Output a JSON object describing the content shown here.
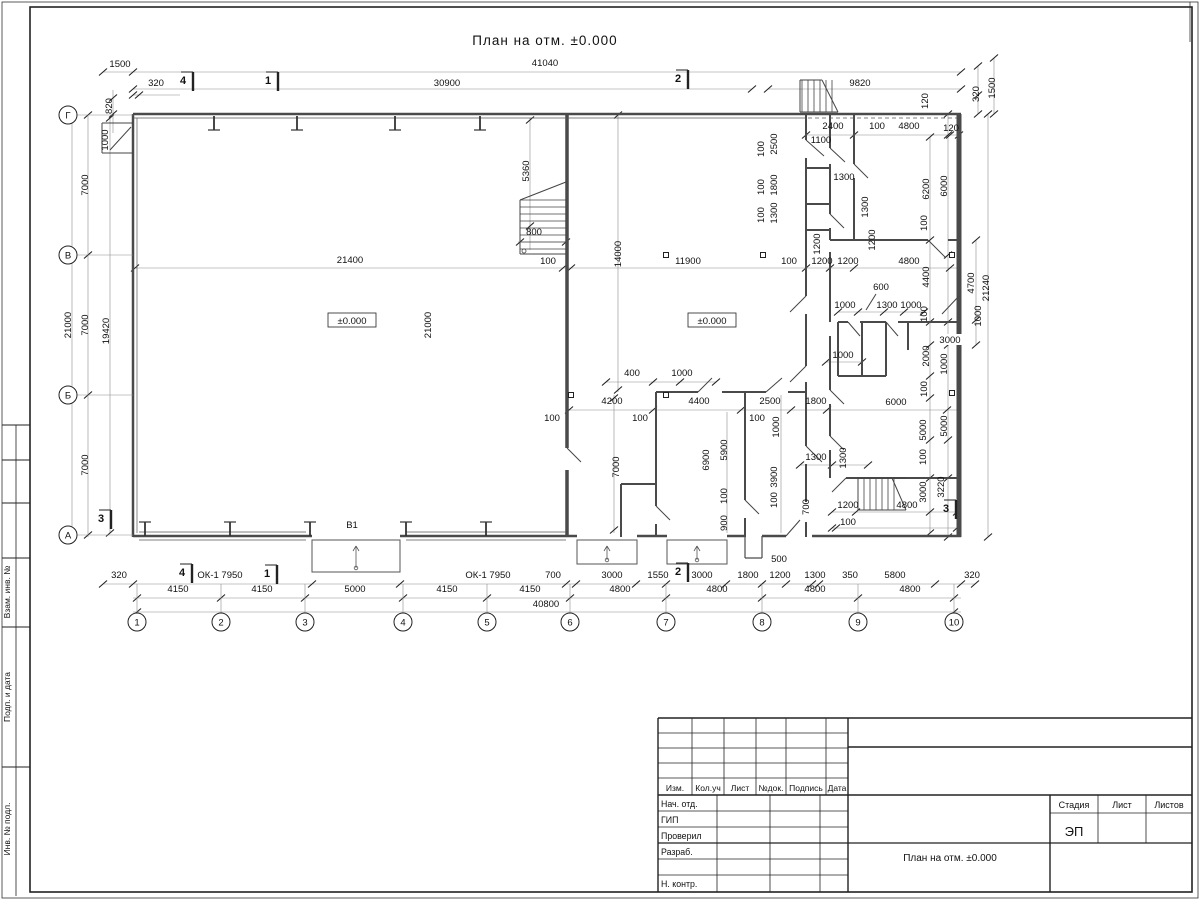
{
  "plan": {
    "title": "План на отм. ±0.000",
    "axis_cols": [
      {
        "label": "1",
        "x": 137
      },
      {
        "label": "2",
        "x": 221
      },
      {
        "label": "3",
        "x": 305
      },
      {
        "label": "4",
        "x": 403
      },
      {
        "label": "5",
        "x": 487
      },
      {
        "label": "6",
        "x": 570
      },
      {
        "label": "7",
        "x": 666
      },
      {
        "label": "8",
        "x": 762
      },
      {
        "label": "9",
        "x": 858
      },
      {
        "label": "10",
        "x": 954
      }
    ],
    "axis_rows": [
      {
        "label": "Г",
        "y": 115
      },
      {
        "label": "В",
        "y": 255
      },
      {
        "label": "Б",
        "y": 395
      },
      {
        "label": "А",
        "y": 535
      }
    ],
    "section_marks": [
      {
        "t": "4",
        "x": 183,
        "y": 81
      },
      {
        "t": "1",
        "x": 268,
        "y": 81
      },
      {
        "t": "2",
        "x": 678,
        "y": 79
      },
      {
        "t": "4",
        "x": 182,
        "y": 573
      },
      {
        "t": "1",
        "x": 267,
        "y": 574
      },
      {
        "t": "2",
        "x": 678,
        "y": 572
      },
      {
        "t": "3",
        "x": 101,
        "y": 519
      },
      {
        "t": "3",
        "x": 946,
        "y": 509
      }
    ],
    "levels": [
      {
        "t": "±0.000",
        "x": 352,
        "y": 323
      },
      {
        "t": "±0.000",
        "x": 712,
        "y": 323
      }
    ],
    "windows": [
      {
        "t": "ОК-1 7950",
        "x": 220,
        "y": 578
      },
      {
        "t": "ОК-1 7950",
        "x": 488,
        "y": 578
      }
    ],
    "gate": {
      "t": "В1",
      "x": 352,
      "y": 528
    },
    "dim_labels": [
      {
        "t": "41040",
        "x": 545,
        "y": 66
      },
      {
        "t": "30900",
        "x": 447,
        "y": 86
      },
      {
        "t": "9820",
        "x": 860,
        "y": 86
      },
      {
        "t": "1500",
        "x": 120,
        "y": 67
      },
      {
        "t": "320",
        "x": 156,
        "y": 86
      },
      {
        "t": "820",
        "x": 112,
        "y": 106,
        "r": 1
      },
      {
        "t": "1000",
        "x": 108,
        "y": 140,
        "r": 1
      },
      {
        "t": "120",
        "x": 928,
        "y": 101,
        "r": 1
      },
      {
        "t": "320",
        "x": 979,
        "y": 94,
        "r": 1
      },
      {
        "t": "1500",
        "x": 995,
        "y": 88,
        "r": 1
      },
      {
        "t": "2400",
        "x": 833,
        "y": 129
      },
      {
        "t": "100",
        "x": 877,
        "y": 129
      },
      {
        "t": "4800",
        "x": 909,
        "y": 129
      },
      {
        "t": "120",
        "x": 951,
        "y": 131
      },
      {
        "t": "1100",
        "x": 821,
        "y": 143
      },
      {
        "t": "1300",
        "x": 844,
        "y": 180
      },
      {
        "t": "100",
        "x": 764,
        "y": 149,
        "r": 1
      },
      {
        "t": "2500",
        "x": 777,
        "y": 144,
        "r": 1
      },
      {
        "t": "100",
        "x": 764,
        "y": 187,
        "r": 1
      },
      {
        "t": "1800",
        "x": 777,
        "y": 185,
        "r": 1
      },
      {
        "t": "100",
        "x": 764,
        "y": 215,
        "r": 1
      },
      {
        "t": "1300",
        "x": 777,
        "y": 213,
        "r": 1
      },
      {
        "t": "1200",
        "x": 820,
        "y": 244,
        "r": 1
      },
      {
        "t": "1300",
        "x": 868,
        "y": 207,
        "r": 1
      },
      {
        "t": "1200",
        "x": 875,
        "y": 240,
        "r": 1
      },
      {
        "t": "6200",
        "x": 929,
        "y": 189,
        "r": 1
      },
      {
        "t": "100",
        "x": 927,
        "y": 223,
        "r": 1
      },
      {
        "t": "6000",
        "x": 947,
        "y": 186,
        "r": 1
      },
      {
        "t": "5360",
        "x": 529,
        "y": 171,
        "r": 1
      },
      {
        "t": "800",
        "x": 534,
        "y": 235
      },
      {
        "t": "14000",
        "x": 621,
        "y": 254,
        "r": 1
      },
      {
        "t": "21400",
        "x": 350,
        "y": 263
      },
      {
        "t": "100",
        "x": 548,
        "y": 264
      },
      {
        "t": "11900",
        "x": 688,
        "y": 264
      },
      {
        "t": "100",
        "x": 789,
        "y": 264
      },
      {
        "t": "1200",
        "x": 822,
        "y": 264
      },
      {
        "t": "1200",
        "x": 848,
        "y": 264
      },
      {
        "t": "4800",
        "x": 909,
        "y": 264
      },
      {
        "t": "7000",
        "x": 88,
        "y": 185,
        "r": 1
      },
      {
        "t": "7000",
        "x": 88,
        "y": 325,
        "r": 1
      },
      {
        "t": "7000",
        "x": 88,
        "y": 465,
        "r": 1
      },
      {
        "t": "21000",
        "x": 71,
        "y": 325,
        "r": 1
      },
      {
        "t": "19420",
        "x": 109,
        "y": 331,
        "r": 1
      },
      {
        "t": "21000",
        "x": 431,
        "y": 325,
        "r": 1
      },
      {
        "t": "600",
        "x": 881,
        "y": 290
      },
      {
        "t": "1000",
        "x": 845,
        "y": 308
      },
      {
        "t": "1300",
        "x": 887,
        "y": 308
      },
      {
        "t": "1000",
        "x": 911,
        "y": 308
      },
      {
        "t": "4400",
        "x": 929,
        "y": 277,
        "r": 1
      },
      {
        "t": "100",
        "x": 927,
        "y": 314,
        "r": 1
      },
      {
        "t": "3000",
        "x": 950,
        "y": 343,
        "b": 1
      },
      {
        "t": "1000",
        "x": 981,
        "y": 316,
        "r": 1
      },
      {
        "t": "1000",
        "x": 947,
        "y": 364,
        "r": 1
      },
      {
        "t": "2000",
        "x": 929,
        "y": 356,
        "r": 1
      },
      {
        "t": "100",
        "x": 927,
        "y": 389,
        "r": 1
      },
      {
        "t": "1000",
        "x": 843,
        "y": 358
      },
      {
        "t": "4700",
        "x": 974,
        "y": 283,
        "r": 1
      },
      {
        "t": "21240",
        "x": 989,
        "y": 288,
        "r": 1
      },
      {
        "t": "400",
        "x": 632,
        "y": 376
      },
      {
        "t": "1000",
        "x": 682,
        "y": 376
      },
      {
        "t": "4200",
        "x": 612,
        "y": 404
      },
      {
        "t": "4400",
        "x": 699,
        "y": 404
      },
      {
        "t": "2500",
        "x": 770,
        "y": 404
      },
      {
        "t": "1800",
        "x": 816,
        "y": 404
      },
      {
        "t": "6000",
        "x": 896,
        "y": 405
      },
      {
        "t": "100",
        "x": 552,
        "y": 421
      },
      {
        "t": "100",
        "x": 640,
        "y": 421
      },
      {
        "t": "100",
        "x": 757,
        "y": 421
      },
      {
        "t": "7000",
        "x": 619,
        "y": 467,
        "r": 1
      },
      {
        "t": "6900",
        "x": 709,
        "y": 460,
        "r": 1
      },
      {
        "t": "5900",
        "x": 727,
        "y": 450,
        "r": 1
      },
      {
        "t": "1000",
        "x": 779,
        "y": 427,
        "r": 1
      },
      {
        "t": "3900",
        "x": 777,
        "y": 477,
        "r": 1
      },
      {
        "t": "1300",
        "x": 816,
        "y": 460
      },
      {
        "t": "1300",
        "x": 846,
        "y": 458,
        "r": 1
      },
      {
        "t": "100",
        "x": 727,
        "y": 496,
        "r": 1
      },
      {
        "t": "100",
        "x": 777,
        "y": 500,
        "r": 1
      },
      {
        "t": "900",
        "x": 727,
        "y": 523,
        "r": 1
      },
      {
        "t": "700",
        "x": 809,
        "y": 507,
        "r": 1
      },
      {
        "t": "1200",
        "x": 848,
        "y": 508
      },
      {
        "t": "100",
        "x": 848,
        "y": 525
      },
      {
        "t": "4800",
        "x": 907,
        "y": 508
      },
      {
        "t": "5000",
        "x": 926,
        "y": 430,
        "r": 1
      },
      {
        "t": "100",
        "x": 926,
        "y": 457,
        "r": 1
      },
      {
        "t": "3000",
        "x": 926,
        "y": 492,
        "r": 1
      },
      {
        "t": "5000",
        "x": 947,
        "y": 426,
        "r": 1
      },
      {
        "t": "3220",
        "x": 944,
        "y": 487,
        "r": 1
      },
      {
        "t": "320",
        "x": 119,
        "y": 578
      },
      {
        "t": "700",
        "x": 553,
        "y": 578
      },
      {
        "t": "3000",
        "x": 612,
        "y": 578
      },
      {
        "t": "1550",
        "x": 658,
        "y": 578
      },
      {
        "t": "3000",
        "x": 702,
        "y": 578
      },
      {
        "t": "1800",
        "x": 748,
        "y": 578
      },
      {
        "t": "500",
        "x": 779,
        "y": 562
      },
      {
        "t": "1200",
        "x": 780,
        "y": 578
      },
      {
        "t": "1300",
        "x": 815,
        "y": 578
      },
      {
        "t": "350",
        "x": 850,
        "y": 578
      },
      {
        "t": "5800",
        "x": 895,
        "y": 578
      },
      {
        "t": "320",
        "x": 972,
        "y": 578
      },
      {
        "t": "4150",
        "x": 178,
        "y": 592
      },
      {
        "t": "4150",
        "x": 262,
        "y": 592
      },
      {
        "t": "5000",
        "x": 355,
        "y": 592
      },
      {
        "t": "4150",
        "x": 447,
        "y": 592
      },
      {
        "t": "4150",
        "x": 530,
        "y": 592
      },
      {
        "t": "4800",
        "x": 620,
        "y": 592
      },
      {
        "t": "4800",
        "x": 717,
        "y": 592
      },
      {
        "t": "4800",
        "x": 815,
        "y": 592
      },
      {
        "t": "4800",
        "x": 910,
        "y": 592
      },
      {
        "t": "40800",
        "x": 546,
        "y": 607
      }
    ]
  },
  "title_block": {
    "header_cols": [
      "Изм.",
      "Кол.уч",
      "Лист",
      "№док.",
      "Подпись",
      "Дата"
    ],
    "roles": [
      "Нач. отд.",
      "ГИП",
      "Проверил",
      "Разраб.",
      "Н. контр."
    ],
    "stage_label": "Стадия",
    "sheet_label": "Лист",
    "sheets_label": "Листов",
    "stage_value": "ЭП",
    "doc_title": "План на отм. ±0.000"
  },
  "side_stamp": {
    "labels": [
      "Взам. инв. №",
      "Подп. и дата",
      "Инв. № подл."
    ]
  }
}
